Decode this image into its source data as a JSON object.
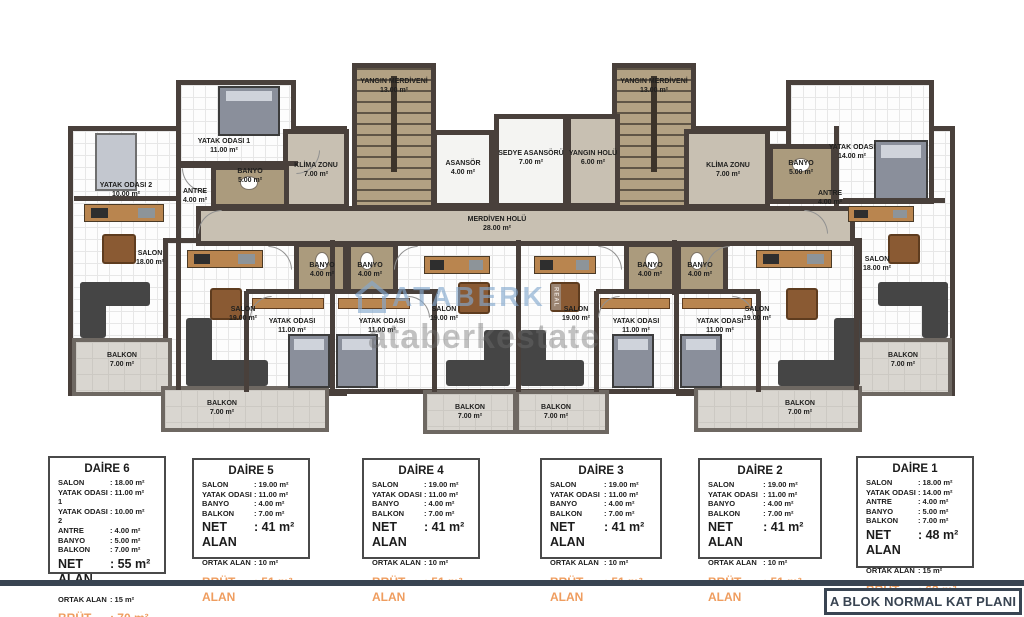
{
  "footer": {
    "title": "A BLOK NORMAL KAT PLANI"
  },
  "watermark": {
    "brand": "ATABERK",
    "tag": "REAL",
    "url_text": "ataberkestate"
  },
  "colors": {
    "wall": "#49403b",
    "accent_orange": "#ef9d5f",
    "navy": "#394452",
    "corridor_beige": "#c8c0b2",
    "stairs_tan": "#b2a183",
    "balcony_gray": "#d9d6d0"
  },
  "labels_meta": {
    "net_label": "NET ALAN",
    "ortak_label": "ORTAK ALAN",
    "brut_label": "BRÜT ALAN"
  },
  "plan": {
    "regions": [
      {
        "id": "left-wing",
        "fill": "tile",
        "x": 68,
        "y": 126,
        "w": 279,
        "h": 270
      },
      {
        "id": "bedroom1-d6-room",
        "fill": "tile",
        "x": 176,
        "y": 80,
        "w": 120,
        "h": 88
      },
      {
        "id": "right-wing",
        "fill": "tile",
        "x": 676,
        "y": 126,
        "w": 279,
        "h": 270
      },
      {
        "id": "bedroom-d1-room",
        "fill": "tile",
        "x": 786,
        "y": 80,
        "w": 148,
        "h": 124
      },
      {
        "id": "middle-band",
        "fill": "tile",
        "x": 163,
        "y": 238,
        "w": 699,
        "h": 156
      },
      {
        "id": "fire-stairs-left",
        "fill": "stairs",
        "x": 352,
        "y": 63,
        "w": 84,
        "h": 147
      },
      {
        "id": "fire-stairs-right",
        "fill": "stairs",
        "x": 612,
        "y": 63,
        "w": 84,
        "h": 147
      },
      {
        "id": "elevator-room",
        "fill": "lift",
        "x": 432,
        "y": 130,
        "w": 62,
        "h": 78
      },
      {
        "id": "stretcher-elevator-room",
        "fill": "lift",
        "x": 494,
        "y": 114,
        "w": 74,
        "h": 94
      },
      {
        "id": "fire-hall-room",
        "fill": "beige",
        "x": 566,
        "y": 114,
        "w": 54,
        "h": 94
      },
      {
        "id": "corridor",
        "fill": "beige",
        "x": 196,
        "y": 206,
        "w": 659,
        "h": 40
      },
      {
        "id": "hvac-zone-left",
        "fill": "beige",
        "x": 283,
        "y": 129,
        "w": 66,
        "h": 80
      },
      {
        "id": "hvac-zone-right",
        "fill": "beige",
        "x": 684,
        "y": 129,
        "w": 86,
        "h": 80
      },
      {
        "id": "balcony-d6-room",
        "fill": "balcony",
        "x": 72,
        "y": 338,
        "w": 100,
        "h": 58
      },
      {
        "id": "balcony-d1-room",
        "fill": "balcony",
        "x": 852,
        "y": 338,
        "w": 100,
        "h": 58
      },
      {
        "id": "balcony-d5-room",
        "fill": "balcony",
        "x": 161,
        "y": 386,
        "w": 168,
        "h": 46
      },
      {
        "id": "balcony-d4-room",
        "fill": "balcony",
        "x": 423,
        "y": 390,
        "w": 94,
        "h": 44
      },
      {
        "id": "balcony-d3-room",
        "fill": "balcony",
        "x": 515,
        "y": 390,
        "w": 94,
        "h": 44
      },
      {
        "id": "balcony-d2-room",
        "fill": "balcony",
        "x": 694,
        "y": 386,
        "w": 168,
        "h": 46
      },
      {
        "id": "bath-d5-room",
        "fill": "bath",
        "x": 294,
        "y": 242,
        "w": 54,
        "h": 52
      },
      {
        "id": "bath-d4-room",
        "fill": "bath",
        "x": 346,
        "y": 242,
        "w": 52,
        "h": 52
      },
      {
        "id": "bath-d3-room",
        "fill": "bath",
        "x": 624,
        "y": 242,
        "w": 54,
        "h": 52
      },
      {
        "id": "bath-d2-room",
        "fill": "bath",
        "x": 676,
        "y": 242,
        "w": 52,
        "h": 52
      },
      {
        "id": "bath-d6-room",
        "fill": "bath",
        "x": 211,
        "y": 165,
        "w": 78,
        "h": 44
      },
      {
        "id": "bath-d1-room",
        "fill": "bath",
        "x": 768,
        "y": 144,
        "w": 68,
        "h": 60
      }
    ],
    "walls": [
      [
        74,
        196,
        104,
        5
      ],
      [
        176,
        124,
        5,
        118
      ],
      [
        176,
        161,
        122,
        5
      ],
      [
        176,
        240,
        5,
        150
      ],
      [
        330,
        240,
        5,
        55
      ],
      [
        516,
        240,
        5,
        152
      ],
      [
        672,
        240,
        5,
        55
      ],
      [
        854,
        240,
        5,
        150
      ],
      [
        246,
        289,
        86,
        5
      ],
      [
        244,
        291,
        5,
        101
      ],
      [
        330,
        291,
        5,
        101
      ],
      [
        332,
        289,
        106,
        5
      ],
      [
        432,
        291,
        5,
        101
      ],
      [
        596,
        289,
        82,
        5
      ],
      [
        594,
        291,
        5,
        101
      ],
      [
        674,
        291,
        5,
        101
      ],
      [
        676,
        289,
        84,
        5
      ],
      [
        756,
        291,
        5,
        101
      ],
      [
        834,
        126,
        5,
        80
      ],
      [
        843,
        198,
        102,
        5
      ]
    ],
    "doors": [
      {
        "x": 268,
        "y": 246,
        "s": 24,
        "r": 90
      },
      {
        "x": 394,
        "y": 246,
        "s": 24,
        "r": 0
      },
      {
        "x": 598,
        "y": 246,
        "s": 24,
        "r": 90
      },
      {
        "x": 706,
        "y": 246,
        "s": 24,
        "r": 0
      },
      {
        "x": 250,
        "y": 296,
        "s": 22,
        "r": 0
      },
      {
        "x": 408,
        "y": 296,
        "s": 22,
        "r": 90
      },
      {
        "x": 598,
        "y": 296,
        "s": 22,
        "r": 0
      },
      {
        "x": 732,
        "y": 296,
        "s": 22,
        "r": 90
      },
      {
        "x": 182,
        "y": 168,
        "s": 24,
        "r": 270
      },
      {
        "x": 198,
        "y": 210,
        "s": 24,
        "r": 0
      },
      {
        "x": 804,
        "y": 210,
        "s": 24,
        "r": 90
      },
      {
        "x": 296,
        "y": 150,
        "s": 24,
        "r": 180
      }
    ],
    "furniture": [
      {
        "t": "bed",
        "x": 218,
        "y": 86,
        "w": 62,
        "h": 50
      },
      {
        "t": "bed-light",
        "x": 95,
        "y": 133,
        "w": 42,
        "h": 58
      },
      {
        "t": "bed",
        "x": 288,
        "y": 334,
        "w": 42,
        "h": 54
      },
      {
        "t": "bed",
        "x": 336,
        "y": 334,
        "w": 42,
        "h": 54
      },
      {
        "t": "bed",
        "x": 612,
        "y": 334,
        "w": 42,
        "h": 54
      },
      {
        "t": "bed",
        "x": 680,
        "y": 334,
        "w": 42,
        "h": 54
      },
      {
        "t": "bed",
        "x": 874,
        "y": 140,
        "w": 54,
        "h": 60
      },
      {
        "t": "sofa",
        "x": 80,
        "y": 282,
        "w": 70,
        "h": 24
      },
      {
        "t": "sofa",
        "x": 80,
        "y": 282,
        "w": 26,
        "h": 56
      },
      {
        "t": "sofa",
        "x": 186,
        "y": 318,
        "w": 26,
        "h": 68
      },
      {
        "t": "sofa",
        "x": 186,
        "y": 360,
        "w": 82,
        "h": 26
      },
      {
        "t": "sofa",
        "x": 484,
        "y": 330,
        "w": 26,
        "h": 56
      },
      {
        "t": "sofa",
        "x": 446,
        "y": 360,
        "w": 64,
        "h": 26
      },
      {
        "t": "sofa",
        "x": 520,
        "y": 330,
        "w": 26,
        "h": 56
      },
      {
        "t": "sofa",
        "x": 520,
        "y": 360,
        "w": 64,
        "h": 26
      },
      {
        "t": "sofa",
        "x": 834,
        "y": 318,
        "w": 26,
        "h": 68
      },
      {
        "t": "sofa",
        "x": 778,
        "y": 360,
        "w": 82,
        "h": 26
      },
      {
        "t": "sofa",
        "x": 878,
        "y": 282,
        "w": 70,
        "h": 24
      },
      {
        "t": "sofa",
        "x": 922,
        "y": 282,
        "w": 26,
        "h": 56
      },
      {
        "t": "table",
        "x": 102,
        "y": 234,
        "w": 34,
        "h": 30
      },
      {
        "t": "table",
        "x": 210,
        "y": 288,
        "w": 32,
        "h": 32
      },
      {
        "t": "table",
        "x": 458,
        "y": 282,
        "w": 32,
        "h": 32
      },
      {
        "t": "table",
        "x": 550,
        "y": 282,
        "w": 30,
        "h": 30
      },
      {
        "t": "table",
        "x": 786,
        "y": 288,
        "w": 32,
        "h": 32
      },
      {
        "t": "table",
        "x": 888,
        "y": 234,
        "w": 32,
        "h": 30
      },
      {
        "t": "kitchen",
        "x": 84,
        "y": 204,
        "w": 80,
        "h": 18
      },
      {
        "t": "kitchen",
        "x": 187,
        "y": 250,
        "w": 76,
        "h": 18
      },
      {
        "t": "kitchen",
        "x": 424,
        "y": 256,
        "w": 66,
        "h": 18
      },
      {
        "t": "kitchen",
        "x": 534,
        "y": 256,
        "w": 62,
        "h": 18
      },
      {
        "t": "kitchen",
        "x": 756,
        "y": 250,
        "w": 76,
        "h": 18
      },
      {
        "t": "kitchen",
        "x": 848,
        "y": 206,
        "w": 66,
        "h": 16
      },
      {
        "t": "wood",
        "x": 252,
        "y": 298,
        "w": 72,
        "h": 11
      },
      {
        "t": "wood",
        "x": 338,
        "y": 298,
        "w": 72,
        "h": 11
      },
      {
        "t": "wood",
        "x": 600,
        "y": 298,
        "w": 70,
        "h": 11
      },
      {
        "t": "wood",
        "x": 682,
        "y": 298,
        "w": 70,
        "h": 11
      },
      {
        "t": "wc",
        "x": 315,
        "y": 252,
        "w": 14,
        "h": 18
      },
      {
        "t": "wc",
        "x": 360,
        "y": 252,
        "w": 14,
        "h": 18
      },
      {
        "t": "wc",
        "x": 645,
        "y": 252,
        "w": 14,
        "h": 18
      },
      {
        "t": "wc",
        "x": 690,
        "y": 252,
        "w": 14,
        "h": 18
      },
      {
        "t": "wc",
        "x": 240,
        "y": 176,
        "w": 18,
        "h": 14
      },
      {
        "t": "wc",
        "x": 792,
        "y": 158,
        "w": 18,
        "h": 14
      }
    ],
    "labels": [
      {
        "id": "fire-stairs-left-label",
        "name": "YANGIN MERDİVENİ",
        "area": "13.00 m²",
        "x": 394,
        "y": 78
      },
      {
        "id": "fire-stairs-right-label",
        "name": "YANGIN MERDİVENİ",
        "area": "13.00 m²",
        "x": 654,
        "y": 78
      },
      {
        "id": "elevator-label",
        "name": "ASANSÖR",
        "area": "4.00 m²",
        "x": 463,
        "y": 160
      },
      {
        "id": "stretcher-elevator-label",
        "name": "SEDYE ASANSÖRÜ",
        "area": "7.00 m²",
        "x": 531,
        "y": 150
      },
      {
        "id": "fire-hall-label",
        "name": "YANGIN HOLÜ",
        "area": "6.00 m²",
        "x": 593,
        "y": 150
      },
      {
        "id": "stair-hall-label",
        "name": "MERDİVEN HOLÜ",
        "area": "28.00 m²",
        "x": 497,
        "y": 216
      },
      {
        "id": "hvac-left-label",
        "name": "KLİMA ZONU",
        "area": "7.00 m²",
        "x": 316,
        "y": 162
      },
      {
        "id": "hvac-right-label",
        "name": "KLİMA ZONU",
        "area": "7.00 m²",
        "x": 728,
        "y": 162
      },
      {
        "id": "bedroom1-d6-label",
        "name": "YATAK ODASI 1",
        "area": "11.00 m²",
        "x": 224,
        "y": 138
      },
      {
        "id": "bedroom2-d6-label",
        "name": "YATAK ODASI 2",
        "area": "10.00 m²",
        "x": 126,
        "y": 182
      },
      {
        "id": "bath-d6-label",
        "name": "BANYO",
        "area": "5.00 m²",
        "x": 250,
        "y": 168
      },
      {
        "id": "hall-d6-label",
        "name": "ANTRE",
        "area": "4.00 m²",
        "x": 195,
        "y": 188
      },
      {
        "id": "living-d6-label",
        "name": "SALON",
        "area": "18.00 m²",
        "x": 150,
        "y": 250
      },
      {
        "id": "balcony-d6-label",
        "name": "BALKON",
        "area": "7.00 m²",
        "x": 122,
        "y": 352
      },
      {
        "id": "bath-d5-label",
        "name": "BANYO",
        "area": "4.00 m²",
        "x": 322,
        "y": 262
      },
      {
        "id": "living-d5-label",
        "name": "SALON",
        "area": "19.00 m²",
        "x": 243,
        "y": 306
      },
      {
        "id": "bedroom-d5-label",
        "name": "YATAK ODASI",
        "area": "11.00 m²",
        "x": 292,
        "y": 318
      },
      {
        "id": "balcony-d5-label",
        "name": "BALKON",
        "area": "7.00 m²",
        "x": 222,
        "y": 400
      },
      {
        "id": "bath-d4-label",
        "name": "BANYO",
        "area": "4.00 m²",
        "x": 370,
        "y": 262
      },
      {
        "id": "living-d4-label",
        "name": "SALON",
        "area": "19.00 m²",
        "x": 444,
        "y": 306
      },
      {
        "id": "bedroom-d4-label",
        "name": "YATAK ODASI",
        "area": "11.00 m²",
        "x": 382,
        "y": 318
      },
      {
        "id": "balcony-d4-label",
        "name": "BALKON",
        "area": "7.00 m²",
        "x": 470,
        "y": 404
      },
      {
        "id": "bath-d3-label",
        "name": "BANYO",
        "area": "4.00 m²",
        "x": 650,
        "y": 262
      },
      {
        "id": "living-d3-label",
        "name": "SALON",
        "area": "19.00 m²",
        "x": 576,
        "y": 306
      },
      {
        "id": "bedroom-d3-label",
        "name": "YATAK ODASI",
        "area": "11.00 m²",
        "x": 636,
        "y": 318
      },
      {
        "id": "balcony-d3-label",
        "name": "BALKON",
        "area": "7.00 m²",
        "x": 556,
        "y": 404
      },
      {
        "id": "bath-d2-label",
        "name": "BANYO",
        "area": "4.00 m²",
        "x": 700,
        "y": 262
      },
      {
        "id": "living-d2-label",
        "name": "SALON",
        "area": "19.00 m²",
        "x": 757,
        "y": 306
      },
      {
        "id": "bedroom-d2-label",
        "name": "YATAK ODASI",
        "area": "11.00 m²",
        "x": 720,
        "y": 318
      },
      {
        "id": "balcony-d2-label",
        "name": "BALKON",
        "area": "7.00 m²",
        "x": 800,
        "y": 400
      },
      {
        "id": "bedroom-d1-label",
        "name": "YATAK ODASI",
        "area": "14.00 m²",
        "x": 852,
        "y": 144
      },
      {
        "id": "bath-d1-label",
        "name": "BANYO",
        "area": "5.00 m²",
        "x": 801,
        "y": 160
      },
      {
        "id": "hall-d1-label",
        "name": "ANTRE",
        "area": "4.00 m²",
        "x": 830,
        "y": 190
      },
      {
        "id": "living-d1-label",
        "name": "SALON",
        "area": "18.00 m²",
        "x": 877,
        "y": 256
      },
      {
        "id": "balcony-d1-label",
        "name": "BALKON",
        "area": "7.00 m²",
        "x": 903,
        "y": 352
      }
    ]
  },
  "tables": [
    {
      "id": "daire-6",
      "title": "DAİRE 6",
      "x": 48,
      "y": 456,
      "w": 118,
      "h": 118,
      "rows": [
        [
          "SALON",
          ": 18.00 m²"
        ],
        [
          "YATAK ODASI 1",
          ": 11.00 m²"
        ],
        [
          "YATAK ODASI 2",
          ": 10.00 m²"
        ],
        [
          "ANTRE",
          ": 4.00 m²"
        ],
        [
          "BANYO",
          ": 5.00 m²"
        ],
        [
          "BALKON",
          ": 7.00 m²"
        ]
      ],
      "net": ": 55 m²",
      "ortak": ": 15 m²",
      "brut": ": 70 m²"
    },
    {
      "id": "daire-5",
      "title": "DAİRE 5",
      "x": 192,
      "y": 458,
      "w": 118,
      "h": 101,
      "rows": [
        [
          "SALON",
          ": 19.00 m²"
        ],
        [
          "YATAK ODASI",
          ": 11.00 m²"
        ],
        [
          "BANYO",
          ": 4.00 m²"
        ],
        [
          "BALKON",
          ": 7.00 m²"
        ]
      ],
      "net": ": 41 m²",
      "ortak": ": 10 m²",
      "brut": ": 51 m²"
    },
    {
      "id": "daire-4",
      "title": "DAİRE 4",
      "x": 362,
      "y": 458,
      "w": 118,
      "h": 101,
      "rows": [
        [
          "SALON",
          ": 19.00 m²"
        ],
        [
          "YATAK ODASI",
          ": 11.00 m²"
        ],
        [
          "BANYO",
          ": 4.00 m²"
        ],
        [
          "BALKON",
          ": 7.00 m²"
        ]
      ],
      "net": ": 41 m²",
      "ortak": ": 10 m²",
      "brut": ": 51 m²"
    },
    {
      "id": "daire-3",
      "title": "DAİRE 3",
      "x": 540,
      "y": 458,
      "w": 122,
      "h": 101,
      "rows": [
        [
          "SALON",
          ": 19.00 m²"
        ],
        [
          "YATAK ODASI",
          ": 11.00 m²"
        ],
        [
          "BANYO",
          ": 4.00 m²"
        ],
        [
          "BALKON",
          ": 7.00 m²"
        ]
      ],
      "net": ": 41 m²",
      "ortak": ": 10 m²",
      "brut": ": 51 m²"
    },
    {
      "id": "daire-2",
      "title": "DAİRE 2",
      "x": 698,
      "y": 458,
      "w": 124,
      "h": 101,
      "rows": [
        [
          "SALON",
          ": 19.00 m²"
        ],
        [
          "YATAK ODASI",
          ": 11.00 m²"
        ],
        [
          "BANYO",
          ": 4.00 m²"
        ],
        [
          "BALKON",
          ": 7.00 m²"
        ]
      ],
      "net": ": 41 m²",
      "ortak": ": 10 m²",
      "brut": ": 51 m²"
    },
    {
      "id": "daire-1",
      "title": "DAİRE 1",
      "x": 856,
      "y": 456,
      "w": 118,
      "h": 112,
      "rows": [
        [
          "SALON",
          ": 18.00 m²"
        ],
        [
          "YATAK ODASI",
          ": 14.00 m²"
        ],
        [
          "ANTRE",
          ": 4.00 m²"
        ],
        [
          "BANYO",
          ": 5.00 m²"
        ],
        [
          "BALKON",
          ": 7.00 m²"
        ]
      ],
      "net": ": 48 m²",
      "ortak": ": 15 m²",
      "brut": ": 63 m²"
    }
  ]
}
